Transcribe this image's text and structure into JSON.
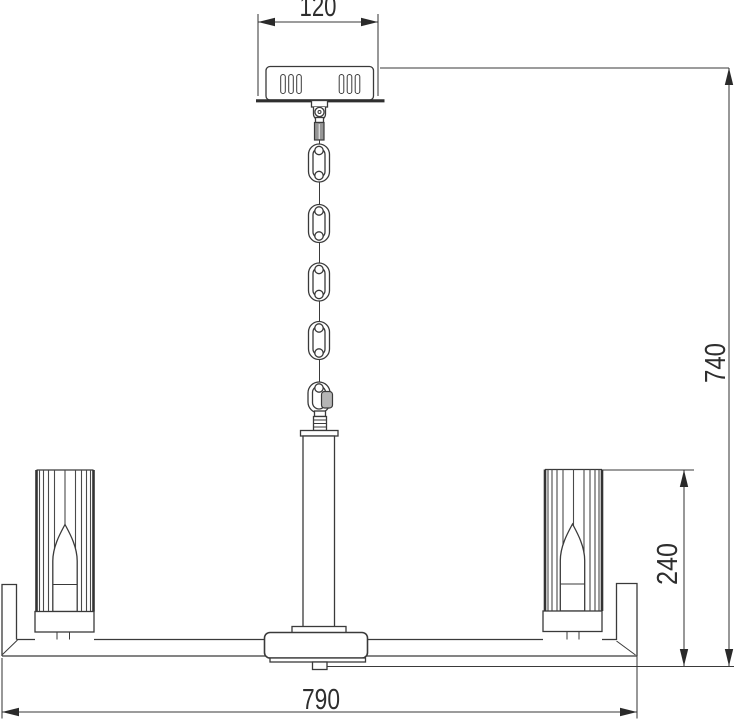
{
  "drawing": {
    "type": "technical-dimension-diagram",
    "subject": "chandelier side view",
    "dimensions": {
      "canopy_width": "120",
      "overall_height": "740",
      "shade_section_height": "240",
      "arm_length": "790"
    },
    "colors": {
      "line": "#3a3a3a",
      "background": "#ffffff",
      "metal_fill": "#969696",
      "gate_fill": "#b5b5b5",
      "text": "#2e2e2e"
    }
  }
}
